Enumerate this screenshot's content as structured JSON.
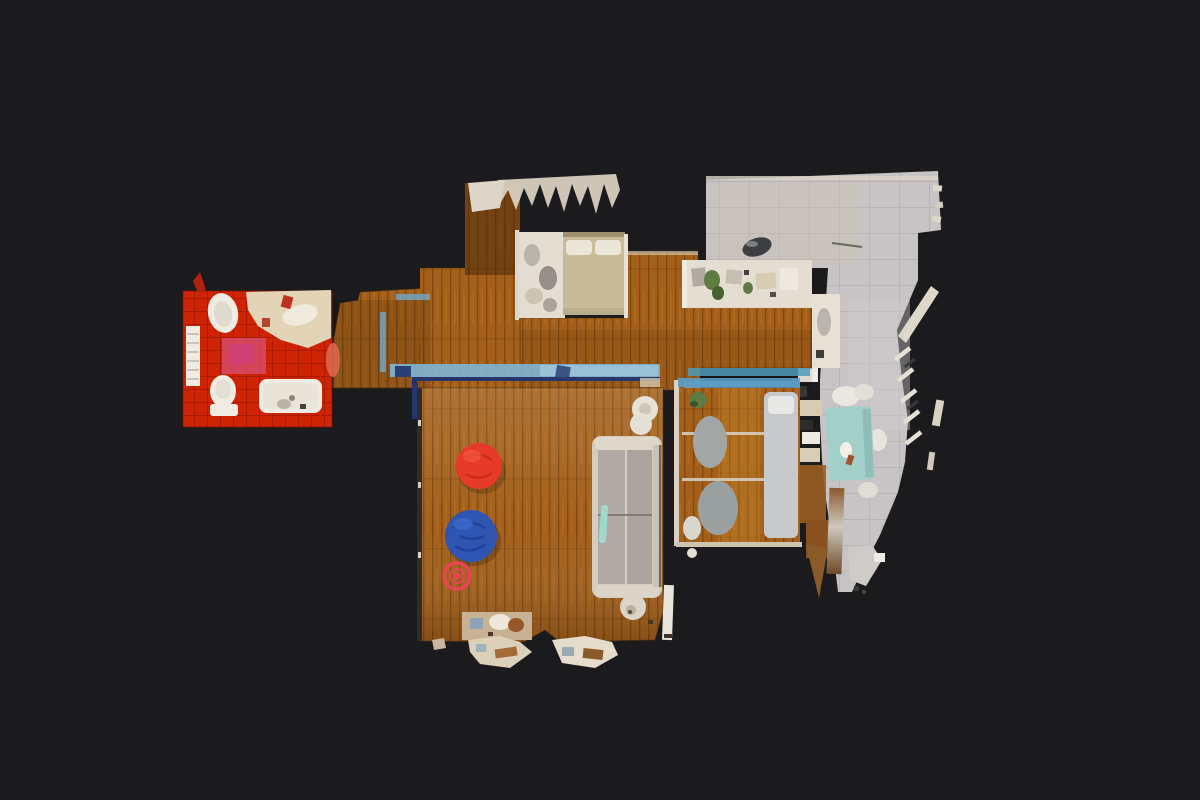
{
  "scene": {
    "description": "Top-down dollhouse floor plan view of a 3D-scanned apartment on a dark background",
    "marker": {
      "name": "panorama-view-tag",
      "shape": "concentric-circles"
    }
  },
  "colors": {
    "bg": "#1b1b1e",
    "wood-base": "#a4601a",
    "wood-light": "#c07e2c",
    "wood-deep": "#5f3408",
    "bath-red": "#ce2404",
    "bath-grout": "#a51a00",
    "bath-pink": "#d9527d",
    "fixture-white": "#f1ece2",
    "counter-beige": "#e3d4b8",
    "terr-gray": "#c8c4c5",
    "terr-line": "#b5b0b2",
    "blue-light": "#7fb5d6",
    "blue-teal": "#4f9bb8",
    "blue-navy": "#26356e",
    "glass-table": "#a3cfc9",
    "sofa-frame": "#d3ccbf",
    "sofa-cushion": "#b0aaa4",
    "bed-tan": "#c9bb99",
    "pillow": "#ece6d8",
    "desk-gray": "#a2a7a6",
    "plant-green": "#5d7b43",
    "bean-red": "#e73a28",
    "bean-blue": "#2e55b2",
    "tag-red": "#ef4254",
    "artifact-beige": "#ddd0ba",
    "clutter-bg": "#e3ddd2"
  }
}
